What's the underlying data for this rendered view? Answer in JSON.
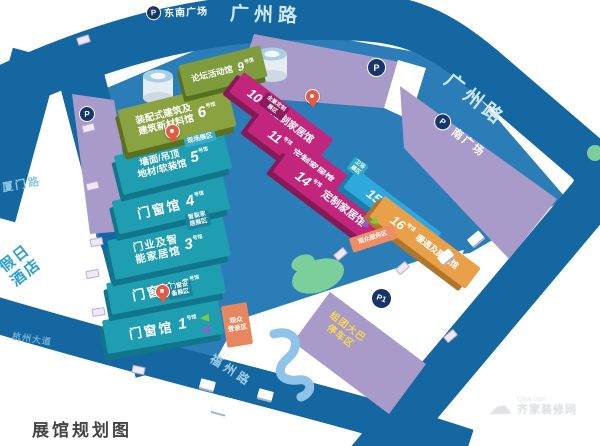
{
  "title": "展馆规划图",
  "hall_unit": "号馆",
  "halls": [
    {
      "num": "1",
      "name1": "门窗馆"
    },
    {
      "num": "2",
      "name1": "门窗馆"
    },
    {
      "num": "3",
      "name1": "门业及智",
      "name2": "能家居馆"
    },
    {
      "num": "4",
      "name1": "门窗馆"
    },
    {
      "num": "5",
      "name1": "墙面/吊顶",
      "name2": "地材/软装馆"
    },
    {
      "num": "6",
      "name1": "装配式建筑及",
      "name2": "建筑新材料馆"
    },
    {
      "num": "9",
      "name1": "论坛活动馆"
    },
    {
      "num": "10",
      "name1": "定制家居馆"
    },
    {
      "num": "11",
      "name1": "定制家居馆"
    },
    {
      "num": "14",
      "name1": "定制家居馆"
    },
    {
      "num": "15",
      "name1": "卫浴馆"
    },
    {
      "num": "16",
      "name1": "暖通及厨电馆"
    }
  ],
  "zones": {
    "onsite": "现场展区",
    "smart": {
      "l1": "智能家",
      "l2": "居展区"
    },
    "equipment": {
      "l1": "门窗设",
      "l2": "备展区"
    },
    "custom": {
      "l1": "全屋定制",
      "l2": "展区"
    },
    "bath": {
      "l1": "卫浴",
      "l2": "展区"
    },
    "register": {
      "l1": "观众",
      "l2": "登录区"
    },
    "service": "观众服务区"
  },
  "plazas": {
    "southeast": "东南广场",
    "south": "南广场",
    "bus": {
      "l1": "组团大巴",
      "l2": "停车区"
    },
    "p": "P",
    "p1": "P1"
  },
  "roads": {
    "guangzhou_top": "广州路",
    "guangzhou_right": "广州路",
    "xiamen": "厦门路",
    "fuzhou": "福州路",
    "avenue": "杭州大道"
  },
  "hotel": {
    "l1": "假日",
    "l2": "酒店"
  },
  "watermark": {
    "line1": "Qijia.com",
    "line2": "齐家装修网"
  },
  "colors": {
    "road": "#1467a0",
    "ground": "#2b7db8",
    "plaza": "#a89bc9",
    "hall_teal": "#1f9eb2",
    "hall_green": "#8aa23f",
    "hall_magenta": "#c2267c",
    "hall_blue": "#2fa8dd",
    "hall_orange": "#e9a049",
    "pin": "#e85843",
    "accent_box": "#e8875f",
    "bus_text": "#f7d84b"
  }
}
